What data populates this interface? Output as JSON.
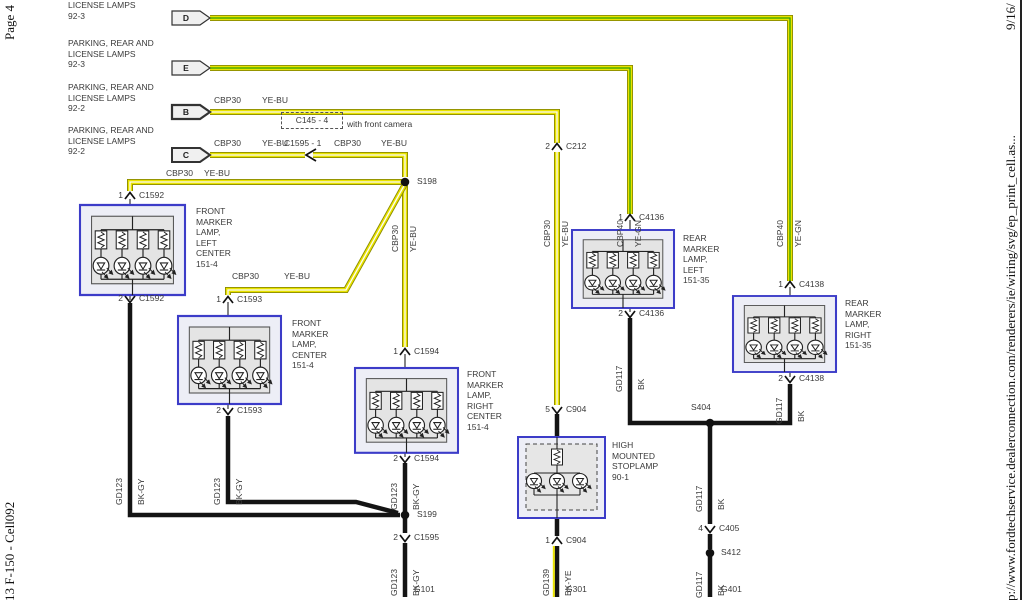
{
  "page_side": {
    "left_top": "Page 4",
    "left_bottom": "13 F-150 - Cell092",
    "right_url": "p://www.fordtechservice.dealerconnection.com/renderers/ie/wiring/svg/ep_print_cell.as...",
    "right_date": "9/16/"
  },
  "circuit_refs": [
    {
      "tag": "D",
      "ref": "LICENSE LAMPS\n92-3"
    },
    {
      "tag": "E",
      "ref": "PARKING, REAR AND\nLICENSE LAMPS\n92-3"
    },
    {
      "tag": "B",
      "ref": "PARKING, REAR AND\nLICENSE LAMPS\n92-2"
    },
    {
      "tag": "C",
      "ref": "PARKING, REAR AND\nLICENSE LAMPS\n92-2"
    }
  ],
  "components": [
    {
      "name": "FRONT\nMARKER\nLAMP,\nLEFT\nCENTER\n151-4"
    },
    {
      "name": "FRONT\nMARKER\nLAMP,\nCENTER\n151-4"
    },
    {
      "name": "FRONT\nMARKER\nLAMP,\nRIGHT\nCENTER\n151-4"
    },
    {
      "name": "REAR\nMARKER\nLAMP,\nLEFT\n151-35"
    },
    {
      "name": "REAR\nMARKER\nLAMP,\nRIGHT\n151-35"
    },
    {
      "name": "HIGH\nMOUNTED\nSTOPLAMP\n90-1"
    }
  ],
  "camera_note": {
    "connector": "C145 - 4",
    "caption": "with front camera",
    "inline_connector": "C1595 - 1"
  },
  "pins": [
    {
      "n": "1",
      "c": "C1592"
    },
    {
      "n": "2",
      "c": "C1592"
    },
    {
      "n": "1",
      "c": "C1593"
    },
    {
      "n": "2",
      "c": "C1593"
    },
    {
      "n": "1",
      "c": "C1594"
    },
    {
      "n": "2",
      "c": "C1594"
    },
    {
      "n": "2",
      "c": "C212"
    },
    {
      "n": "1",
      "c": "C4136"
    },
    {
      "n": "2",
      "c": "C4136"
    },
    {
      "n": "1",
      "c": "C4138"
    },
    {
      "n": "2",
      "c": "C4138"
    },
    {
      "n": "5",
      "c": "C904"
    },
    {
      "n": "1",
      "c": "C904"
    },
    {
      "n": "2",
      "c": "C1595"
    },
    {
      "n": "4",
      "c": "C405"
    }
  ],
  "splices": [
    {
      "name": "S198"
    },
    {
      "name": "S199"
    },
    {
      "name": "S404"
    },
    {
      "name": "S412"
    }
  ],
  "grounds": [
    {
      "name": "G101"
    },
    {
      "name": "G301"
    },
    {
      "name": "G401"
    }
  ],
  "h_wire_labels": [
    {
      "circuit": "CBP30",
      "color": "YE-BU"
    },
    {
      "circuit": "CBP30",
      "color": "YE-BU"
    },
    {
      "circuit": "CBP30",
      "color": "YE-BU"
    },
    {
      "circuit": "CBP30",
      "color": "YE-BU"
    },
    {
      "circuit": "CBP30",
      "color": "YE-BU"
    }
  ],
  "v_wire_labels": [
    {
      "circuit": "CBP30",
      "color": "YE-BU"
    },
    {
      "circuit": "CBP30",
      "color": "YE-BU"
    },
    {
      "circuit": "CBP40",
      "color": "YE-GN"
    },
    {
      "circuit": "CBP40",
      "color": "YE-GN"
    },
    {
      "circuit": "GD123",
      "color": "BK-GY"
    },
    {
      "circuit": "GD123",
      "color": "BK-GY"
    },
    {
      "circuit": "GD123",
      "color": "BK-GY"
    },
    {
      "circuit": "GD123",
      "color": "BK-GY"
    },
    {
      "circuit": "GD139",
      "color": "BK-YE"
    },
    {
      "circuit": "GD117",
      "color": "BK"
    },
    {
      "circuit": "GD117",
      "color": "BK"
    },
    {
      "circuit": "GD117",
      "color": "BK"
    },
    {
      "circuit": "GD117",
      "color": "BK"
    }
  ],
  "colors": {
    "wire_yellow": "#e9e300",
    "wire_edge": "#8a8a00",
    "stripe_bu": "#fbfbfb",
    "stripe_gn": "#2fa000",
    "wire_black": "#141414",
    "box_blue": "#3c3cc8",
    "box_fill": "#edeef6"
  }
}
